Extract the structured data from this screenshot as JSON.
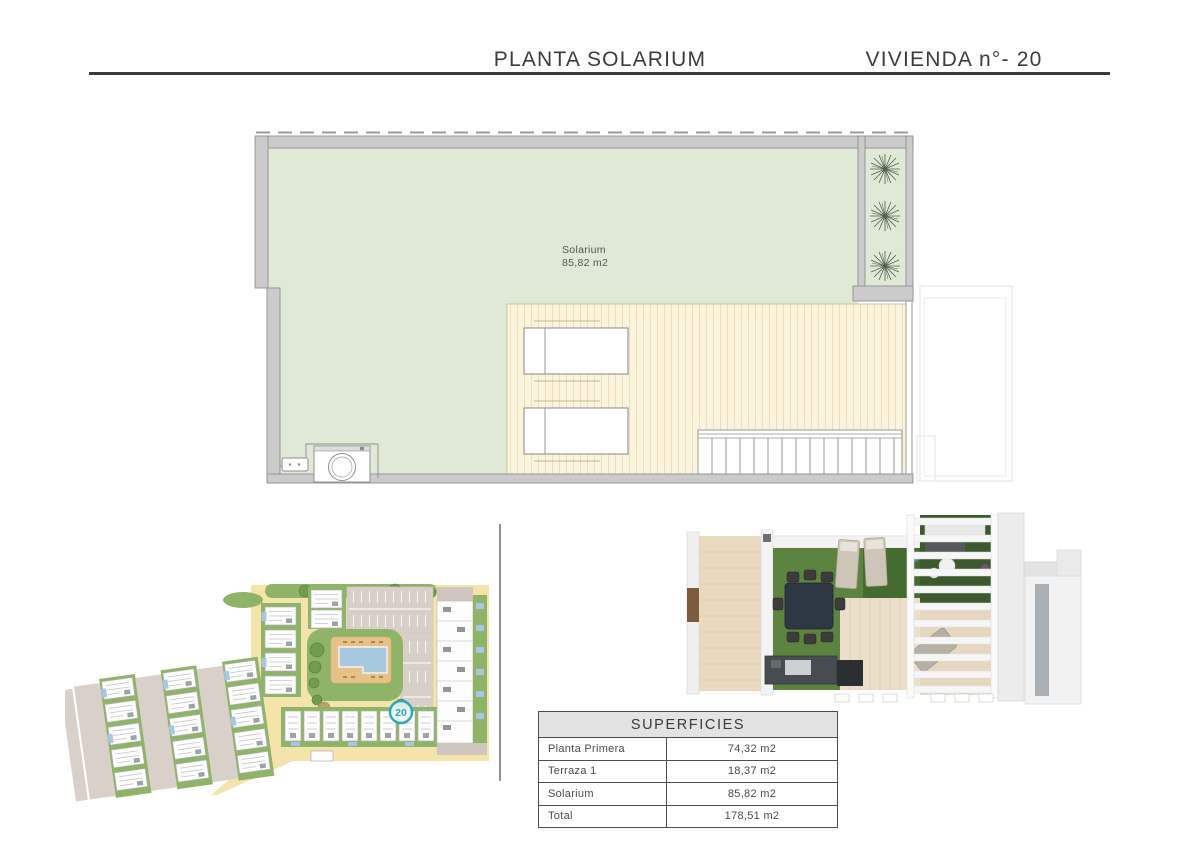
{
  "header": {
    "title_left": "PLANTA SOLARIUM",
    "title_right": "VIVIENDA n°- 20"
  },
  "floor_plan": {
    "room_label": "Solarium",
    "room_area": "85,82 m2"
  },
  "site_plan": {
    "unit_marker": "20"
  },
  "table": {
    "title": "SUPERFICIES",
    "rows": [
      {
        "label": "Planta Primera",
        "value": "74,32 m2"
      },
      {
        "label": "Terraza 1",
        "value": "18,37 m2"
      },
      {
        "label": "Solarium",
        "value": "85,82 m2"
      },
      {
        "label": "Total",
        "value": "178,51 m2"
      }
    ]
  },
  "colors": {
    "rule": "#3a3a3a",
    "plan_green": "#dfe9d6",
    "plan_wall": "#cbcbcb",
    "deck_cream": "#fbf4dc",
    "marker_teal": "#2aa8ba",
    "site_green": "#8fb468",
    "site_beige": "#f5e3ac",
    "site_road": "#d8d0c8",
    "pool_blue": "#a8c8e0",
    "grass_3d": "#5c8440"
  }
}
